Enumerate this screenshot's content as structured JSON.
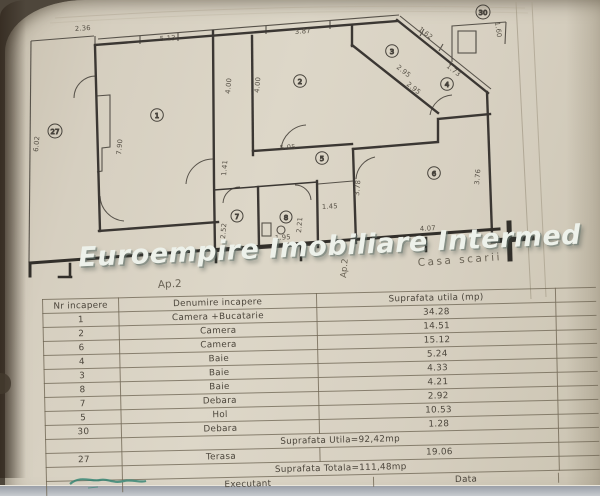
{
  "watermark": "Euroempire Imobiliare Intermed",
  "plan": {
    "apartment_label": "Ap.2",
    "apartment_label_side": "Ap.2",
    "staircase_label": "Casa scarii",
    "rooms": [
      {
        "num": "27",
        "x": 55,
        "y": 131
      },
      {
        "num": "1",
        "x": 157,
        "y": 115
      },
      {
        "num": "2",
        "x": 300,
        "y": 81
      },
      {
        "num": "3",
        "x": 392,
        "y": 51
      },
      {
        "num": "4",
        "x": 447,
        "y": 84
      },
      {
        "num": "5",
        "x": 322,
        "y": 158
      },
      {
        "num": "6",
        "x": 434,
        "y": 173
      },
      {
        "num": "7",
        "x": 237,
        "y": 216
      },
      {
        "num": "8",
        "x": 286,
        "y": 217
      },
      {
        "num": "30",
        "x": 483,
        "y": 12
      }
    ],
    "dims": [
      {
        "t": "2.36"
      },
      {
        "t": "5.13"
      },
      {
        "t": "3.87"
      },
      {
        "t": "1.62"
      },
      {
        "t": "1.73"
      },
      {
        "t": "2.95"
      },
      {
        "t": "2.95"
      },
      {
        "t": "1.60"
      },
      {
        "t": "6.02"
      },
      {
        "t": "7.90"
      },
      {
        "t": "4.00"
      },
      {
        "t": "4.00"
      },
      {
        "t": "5.05"
      },
      {
        "t": "1.41"
      },
      {
        "t": "3.78"
      },
      {
        "t": "3.76"
      },
      {
        "t": "2.52"
      },
      {
        "t": "2.21"
      },
      {
        "t": "1.95"
      },
      {
        "t": "1.45"
      },
      {
        "t": "4.07"
      }
    ]
  },
  "table": {
    "headers": {
      "nr": "Nr incapere",
      "name": "Denumire incapere",
      "area": "Suprafata utila (mp)"
    },
    "rows": [
      {
        "nr": "1",
        "name": "Camera +Bucatarie",
        "area": "34.28"
      },
      {
        "nr": "2",
        "name": "Camera",
        "area": "14.51"
      },
      {
        "nr": "6",
        "name": "Camera",
        "area": "15.12"
      },
      {
        "nr": "4",
        "name": "Baie",
        "area": "5.24"
      },
      {
        "nr": "3",
        "name": "Baie",
        "area": "4.33"
      },
      {
        "nr": "8",
        "name": "Baie",
        "area": "4.21"
      },
      {
        "nr": "7",
        "name": "Debara",
        "area": "2.92"
      },
      {
        "nr": "5",
        "name": "Hol",
        "area": "10.53"
      },
      {
        "nr": "30",
        "name": "Debara",
        "area": "1.28"
      }
    ],
    "subtotal": "Suprafata Utila=92,42mp",
    "terasa": {
      "nr": "27",
      "name": "Terasa",
      "area": "19.06"
    },
    "total": "Suprafata Totala=111,48mp",
    "footer": {
      "executant": "Executant",
      "data": "Data"
    }
  },
  "colors": {
    "paper": "#d7d0c1",
    "wall_ink": "#3b3733",
    "table_line": "#70664f",
    "watermark": "#edf1ea",
    "signature_teal": "#2e8271"
  }
}
